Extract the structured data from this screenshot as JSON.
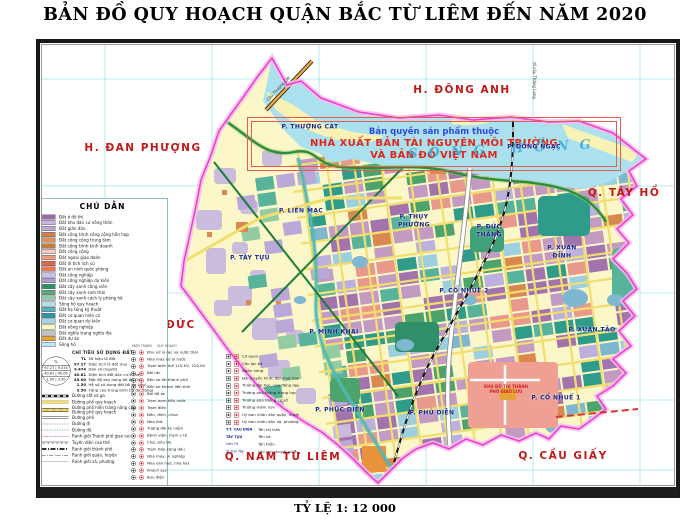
{
  "title": "BẢN ĐỒ QUY HOẠCH QUẬN BẮC TỪ LIÊM ĐẾN NĂM 2020",
  "scale_text": "TỶ LỆ 1: 12 000",
  "river_label": "SÔNG HỒNG",
  "watermark": {
    "line1": "Bản quyền sản phẩm thuộc",
    "line2": "NHÀ XUẤT BẢN TÀI NGUYÊN MÔI TRƯỜNG",
    "line3": "VÀ BẢN ĐỒ VIỆT NAM"
  },
  "map": {
    "colors": {
      "boundary": "#ee3fd0",
      "boundary_halo": "#f8bdef",
      "river": "#abe0ee",
      "sandbar": "#f8f3b4",
      "agriculture": "#fbf7c8",
      "grid": "#9be6ec",
      "district_label": "#c21818",
      "ward_label": "#18288c"
    },
    "neighbors": [
      {
        "label": "H.  ĐÔNG  ANH",
        "x": 462,
        "y": 90
      },
      {
        "label": "H. ĐAN PHƯỢNG",
        "x": 143,
        "y": 148
      },
      {
        "label": "Q. TÂY HỒ",
        "x": 624,
        "y": 193
      },
      {
        "label": "H. HOÀI ĐỨC",
        "x": 150,
        "y": 325
      },
      {
        "label": "Q. NAM TỪ LIÊM",
        "x": 283,
        "y": 457
      },
      {
        "label": "Q. CẦU GIẤY",
        "x": 563,
        "y": 456
      }
    ],
    "wards": [
      {
        "label": "P. THƯỢNG CÁT",
        "x": 310,
        "y": 127,
        "wrap": false
      },
      {
        "label": "P. LIÊN MẠC",
        "x": 301,
        "y": 211,
        "wrap": false
      },
      {
        "label": "P. THỤY PHƯƠNG",
        "x": 414,
        "y": 221,
        "wrap": true
      },
      {
        "label": "P. ĐÔNG NGẠC",
        "x": 534,
        "y": 147,
        "wrap": false
      },
      {
        "label": "P. ĐỨC THẮNG",
        "x": 489,
        "y": 231,
        "wrap": true
      },
      {
        "label": "P. TÂY TỰU",
        "x": 250,
        "y": 258,
        "wrap": false
      },
      {
        "label": "P. CỔ NHUẾ 2",
        "x": 464,
        "y": 291,
        "wrap": false
      },
      {
        "label": "P. XUÂN ĐỈNH",
        "x": 562,
        "y": 252,
        "wrap": true
      },
      {
        "label": "P. MINH KHAI",
        "x": 334,
        "y": 332,
        "wrap": false
      },
      {
        "label": "P. XUÂN TẢO",
        "x": 592,
        "y": 330,
        "wrap": false
      },
      {
        "label": "P. PHÚC DIỄN",
        "x": 340,
        "y": 410,
        "wrap": false
      },
      {
        "label": "P. PHÚ DIỄN",
        "x": 432,
        "y": 413,
        "wrap": false
      },
      {
        "label": "P. CỔ NHUẾ 1",
        "x": 556,
        "y": 398,
        "wrap": false
      }
    ],
    "micro_labels": [
      {
        "text": "Cầu Thượng Cát",
        "x": 262,
        "y": 86,
        "rot": -47,
        "cls": ""
      },
      {
        "text": "đi cầu Thăng Long",
        "x": 516,
        "y": 78,
        "rot": 90,
        "cls": ""
      },
      {
        "text": "KHU ĐÔ THỊ THÀNH PHỐ GIAO LƯU",
        "x": 482,
        "y": 384,
        "rot": 0,
        "cls": "red"
      }
    ]
  },
  "legend": {
    "title": "CHÚ DẪN",
    "land_use": [
      {
        "label": "Đất ở đô thị",
        "color": "#9e6baa"
      },
      {
        "label": "Đất khu dân cư nông thôn",
        "color": "#c7b7de"
      },
      {
        "label": "Đất giãn dân",
        "color": "#b9a8d8"
      },
      {
        "label": "Đất công trình công cộng hỗn hợp",
        "color": "#d08050"
      },
      {
        "label": "Đất công cộng trung tâm",
        "color": "#db9258"
      },
      {
        "label": "Đất công trình kinh doanh",
        "color": "#c97a40"
      },
      {
        "label": "Đất công cộng",
        "color": "#f4ccc0"
      },
      {
        "label": "Đất ngoại giao đoàn",
        "color": "#ec9b7e"
      },
      {
        "label": "Đất di tích lịch sử",
        "color": "#e4664a"
      },
      {
        "label": "Đất an ninh quốc phòng",
        "color": "#e87a58"
      },
      {
        "label": "Đất công nghiệp",
        "color": "#c9c2e8"
      },
      {
        "label": "Đất công nghiệp dự kiến",
        "color": "#ab9ed6"
      },
      {
        "label": "Đất cây xanh công viên",
        "color": "#2f8f69"
      },
      {
        "label": "Đất cây xanh sinh thái",
        "color": "#55ac7b"
      },
      {
        "label": "Đất cây xanh cách ly phòng hộ",
        "color": "#93cca2"
      },
      {
        "label": "Sông hồ quy hoạch",
        "color": "#b3deea"
      },
      {
        "label": "Đất hạ tầng kỹ thuật",
        "color": "#57b1bf"
      },
      {
        "label": "Đất cơ quan hiện có",
        "color": "#2e97a6"
      },
      {
        "label": "Đất cơ quan dự kiến",
        "color": "#a3d3e2"
      },
      {
        "label": "Đất nông nghiệp",
        "color": "#fbf8c8"
      },
      {
        "label": "Đất nghĩa trang nghĩa địa",
        "color": "#c2c2c2"
      },
      {
        "label": "Đất dự án",
        "color": "#e8a23c"
      },
      {
        "label": "Sông hồ",
        "color": "#bfe9f2"
      }
    ],
    "indicator_title": "CHỈ TIÊU SỬ DỤNG ĐẤT",
    "indicators": [
      {
        "value": "TL",
        "label": "Số hiệu lô đất"
      },
      {
        "value": "97.27",
        "label": "Diện tích lô đất (ha)"
      },
      {
        "value": "9.474",
        "label": "Dân số (người)"
      },
      {
        "value": "40.81",
        "label": "Diện tích đất dân cư ở (ha)"
      },
      {
        "value": "45.00",
        "label": "Mật độ xây dựng tối đa (%)"
      },
      {
        "value": "1.50",
        "label": "Hệ số sử dụng đất tối đa (lần)"
      },
      {
        "value": "3.50",
        "label": "Tầng cao trung bình tối đa (tầng)"
      }
    ],
    "lines": [
      {
        "sym": "rail",
        "label": "Đường sắt và ga"
      },
      {
        "sym": "road-y",
        "label": "Đường phố quy hoạch"
      },
      {
        "sym": "road-c",
        "label": "Đường phố hiện trạng nâng cấp",
        "label2": "Đường phố quy hoạch"
      },
      {
        "sym": "road-w",
        "label": "Đường phố"
      },
      {
        "sym": "path",
        "label": "Đường đi"
      },
      {
        "sym": "dike",
        "label": "Đường đê"
      },
      {
        "sym": "red-arrow",
        "label": "Ranh giới Thành phố giao lưu"
      },
      {
        "sym": "power",
        "label": "Tuyến điện cao thế"
      },
      {
        "sym": "b-city",
        "label": "Ranh giới thành phố"
      },
      {
        "sym": "b-dist",
        "label": "Ranh giới quận, huyện"
      },
      {
        "sym": "b-ward",
        "label": "Ranh giới xã, phường"
      }
    ],
    "symbols_header1": "HIỆN TRẠNG",
    "symbols_header2": "QUY HOẠCH",
    "symbols": [
      "Khu xử lý rác và nước thải",
      "Nhà máy xử lý nước",
      "Trạm biến thế 110 KV, 220 KV",
      "Bãi rác",
      "Bến xe tải thành phố",
      "Bến xe khách liên tỉnh",
      "Bãi đỗ xe",
      "Trạm bơm tiêu nước",
      "Trạm điện",
      "Đền, đình, chùa",
      "Nhà thờ",
      "Tượng đài kỷ niệm",
      "Bệnh viện, trạm y tế",
      "Chợ, siêu thị",
      "Trạm tiếp xăng dầu",
      "Nhà máy, xí nghiệp",
      "Nhà văn hoá, nhà hát",
      "Khách sạn",
      "Bưu điện"
    ],
    "symbols2": [
      "Cơ quan",
      "Câu lạc bộ",
      "Ngân hàng",
      "Đài truyền hình, đài phát thanh",
      "Trường đại học, cao đẳng dạy nghề",
      "Trường phổ thông trung học",
      "Trường phổ thông cơ sở",
      "Trường mầm non",
      "Uỷ ban nhân dân quận, huyện",
      "Uỷ ban nhân dân xã, phường"
    ],
    "names": [
      {
        "sample": "T.T. CẦU DIỄN",
        "italic": false,
        "label": "Tên thị trấn"
      },
      {
        "sample": "TÂY TỰU",
        "italic": false,
        "label": "Tên xã"
      },
      {
        "sample": "Văn Trì",
        "italic": true,
        "label": "Tên thôn"
      },
      {
        "sample": "đi Sơn Tây",
        "italic": true,
        "label": "Ghi chú thuyết minh"
      }
    ]
  }
}
